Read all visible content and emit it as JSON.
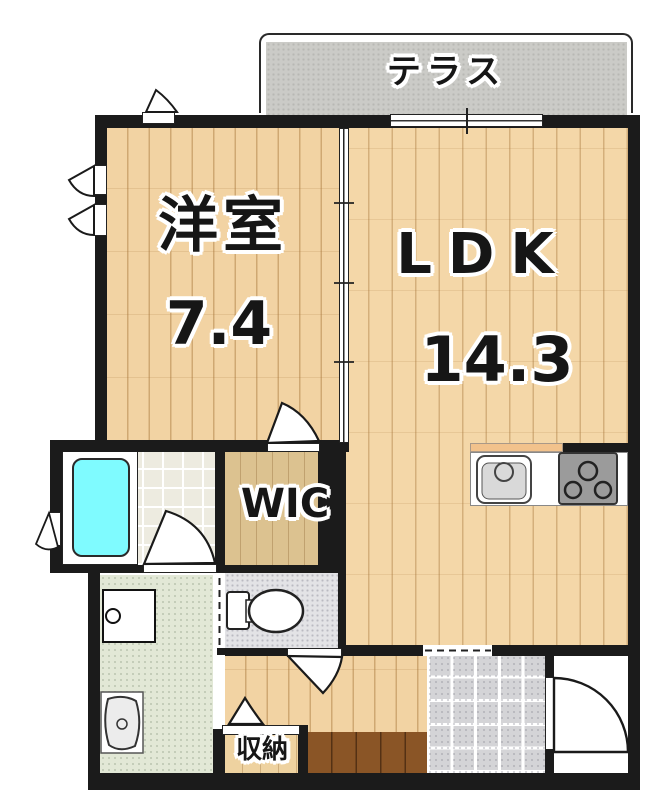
{
  "floorplan": {
    "labels": {
      "terrace": "テラス",
      "western_room": "洋室",
      "western_room_size": "7.4",
      "ldk": "LDK",
      "ldk_size": "14.3",
      "wic": "WIC",
      "storage": "収納"
    },
    "colors": {
      "wall": "#1b1b1b",
      "wood_floor": "#f2d3a3",
      "ldk_floor": "#f4d7a8",
      "wic_floor": "#dcc290",
      "terrace": "#cbcbc7",
      "bathtub": "#7ffbff",
      "genkan_tile": "#d4d4d7",
      "washroom_floor": "#e2e8d6",
      "toilet_floor": "#e3e3e6",
      "step": "#8a5526",
      "counter_edge": "#f2c28c",
      "stove": "#9b9b9b"
    },
    "fixtures": [
      "bathtub",
      "toilet",
      "washing-machine",
      "vanity-sink",
      "kitchen-sink",
      "stove"
    ]
  }
}
